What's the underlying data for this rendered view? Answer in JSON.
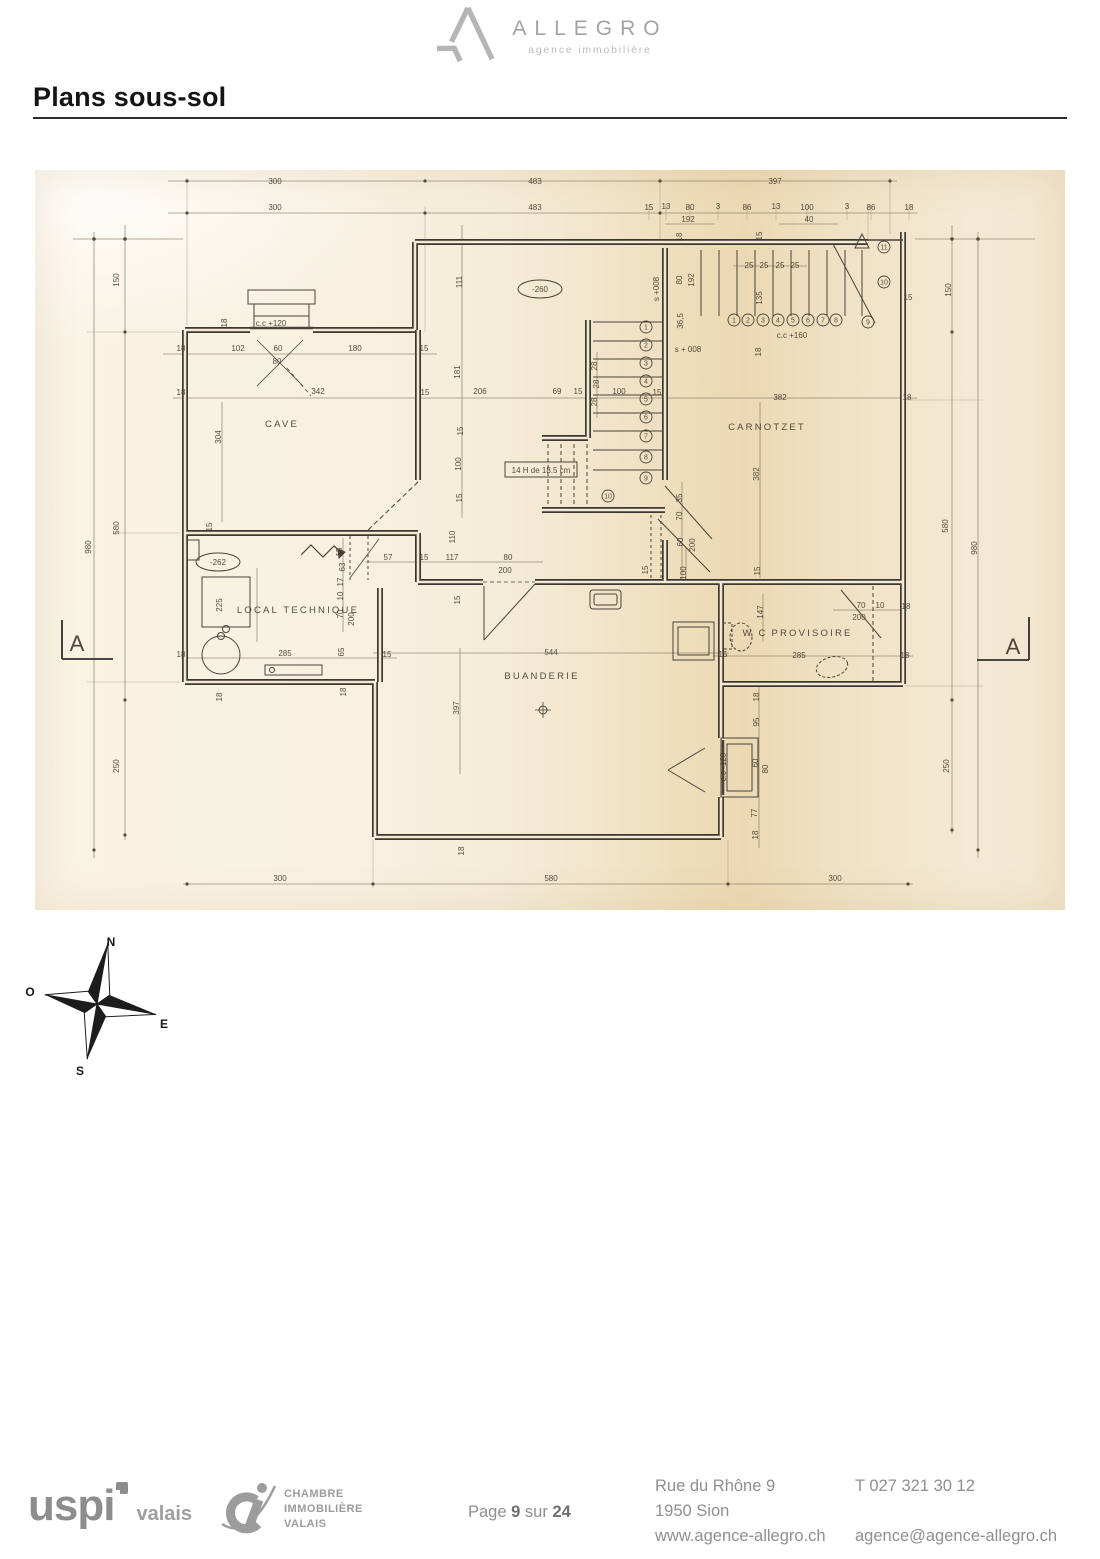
{
  "header": {
    "brand": "ALLEGRO",
    "brand_sub": "agence immobilière"
  },
  "title": "Plans sous-sol",
  "plan": {
    "rooms": [
      {
        "x": 247,
        "y": 257,
        "t": "CAVE"
      },
      {
        "x": 732,
        "y": 260,
        "t": "CARNOTZET"
      },
      {
        "x": 263,
        "y": 443,
        "t": "LOCAL TECHNIQUE"
      },
      {
        "x": 507,
        "y": 509,
        "t": "BUANDERIE"
      },
      {
        "x": 720,
        "y": 466,
        "t": "W C"
      },
      {
        "x": 777,
        "y": 466,
        "t": "PROVISOIRE"
      }
    ],
    "levels": [
      {
        "x": 505,
        "y": 119,
        "t": "-260"
      },
      {
        "x": 183,
        "y": 392,
        "t": "-262"
      }
    ],
    "note": {
      "x": 506,
      "y": 303,
      "t": "14 H de 18.5 cm"
    },
    "section_markers": [
      {
        "x": 42,
        "y": 481,
        "t": "A"
      },
      {
        "x": 978,
        "y": 484,
        "t": "A"
      }
    ],
    "steps": [
      {
        "x": 611,
        "y": 157,
        "n": "1"
      },
      {
        "x": 611,
        "y": 175,
        "n": "2"
      },
      {
        "x": 611,
        "y": 193,
        "n": "3"
      },
      {
        "x": 611,
        "y": 211,
        "n": "4"
      },
      {
        "x": 611,
        "y": 229,
        "n": "5"
      },
      {
        "x": 611,
        "y": 247,
        "n": "6"
      },
      {
        "x": 611,
        "y": 266,
        "n": "7"
      },
      {
        "x": 611,
        "y": 287,
        "n": "8"
      },
      {
        "x": 611,
        "y": 308,
        "n": "9"
      },
      {
        "x": 573,
        "y": 326,
        "n": "10"
      },
      {
        "x": 699,
        "y": 150,
        "n": "1"
      },
      {
        "x": 713,
        "y": 150,
        "n": "2"
      },
      {
        "x": 728,
        "y": 150,
        "n": "3"
      },
      {
        "x": 743,
        "y": 150,
        "n": "4"
      },
      {
        "x": 758,
        "y": 150,
        "n": "5"
      },
      {
        "x": 773,
        "y": 150,
        "n": "6"
      },
      {
        "x": 788,
        "y": 150,
        "n": "7"
      },
      {
        "x": 801,
        "y": 150,
        "n": "8"
      },
      {
        "x": 833,
        "y": 152,
        "n": "9"
      },
      {
        "x": 849,
        "y": 112,
        "n": "10"
      },
      {
        "x": 849,
        "y": 77,
        "n": "11"
      }
    ],
    "dims": [
      {
        "x": 240,
        "y": 14,
        "t": "300"
      },
      {
        "x": 500,
        "y": 14,
        "t": "483"
      },
      {
        "x": 740,
        "y": 14,
        "t": "397"
      },
      {
        "x": 240,
        "y": 40,
        "t": "300"
      },
      {
        "x": 500,
        "y": 40,
        "t": "483"
      },
      {
        "x": 614,
        "y": 40,
        "t": "15"
      },
      {
        "x": 631,
        "y": 39,
        "t": "13"
      },
      {
        "x": 655,
        "y": 40,
        "t": "80"
      },
      {
        "x": 683,
        "y": 39,
        "t": "3"
      },
      {
        "x": 712,
        "y": 40,
        "t": "86"
      },
      {
        "x": 741,
        "y": 39,
        "t": "13"
      },
      {
        "x": 772,
        "y": 40,
        "t": "100"
      },
      {
        "x": 812,
        "y": 39,
        "t": "3"
      },
      {
        "x": 836,
        "y": 40,
        "t": "86"
      },
      {
        "x": 874,
        "y": 40,
        "t": "18"
      },
      {
        "x": 653,
        "y": 52,
        "t": "192"
      },
      {
        "x": 774,
        "y": 52,
        "t": "40"
      },
      {
        "x": 84,
        "y": 110,
        "t": "150",
        "r": 1
      },
      {
        "x": 84,
        "y": 358,
        "t": "580",
        "r": 1
      },
      {
        "x": 56,
        "y": 377,
        "t": "980",
        "r": 1
      },
      {
        "x": 84,
        "y": 596,
        "t": "250",
        "r": 1
      },
      {
        "x": 916,
        "y": 120,
        "t": "150",
        "r": 1
      },
      {
        "x": 913,
        "y": 356,
        "t": "580",
        "r": 1
      },
      {
        "x": 942,
        "y": 378,
        "t": "980",
        "r": 1
      },
      {
        "x": 914,
        "y": 596,
        "t": "250",
        "r": 1
      },
      {
        "x": 146,
        "y": 181,
        "t": "18"
      },
      {
        "x": 203,
        "y": 181,
        "t": "102"
      },
      {
        "x": 243,
        "y": 181,
        "t": "60"
      },
      {
        "x": 242,
        "y": 194,
        "t": "80"
      },
      {
        "x": 320,
        "y": 181,
        "t": "180"
      },
      {
        "x": 389,
        "y": 181,
        "t": "15"
      },
      {
        "x": 146,
        "y": 225,
        "t": "18"
      },
      {
        "x": 283,
        "y": 224,
        "t": "342"
      },
      {
        "x": 390,
        "y": 225,
        "t": "15"
      },
      {
        "x": 186,
        "y": 267,
        "t": "304",
        "r": 1
      },
      {
        "x": 192,
        "y": 153,
        "t": "18",
        "r": 1
      },
      {
        "x": 236,
        "y": 156,
        "t": "c.c +120"
      },
      {
        "x": 177,
        "y": 357,
        "t": "15",
        "r": 1
      },
      {
        "x": 427,
        "y": 112,
        "t": "111",
        "r": 1
      },
      {
        "x": 425,
        "y": 202,
        "t": "181",
        "r": 1
      },
      {
        "x": 445,
        "y": 224,
        "t": "206"
      },
      {
        "x": 522,
        "y": 224,
        "t": "69"
      },
      {
        "x": 543,
        "y": 224,
        "t": "15"
      },
      {
        "x": 584,
        "y": 224,
        "t": "100"
      },
      {
        "x": 622,
        "y": 225,
        "t": "15"
      },
      {
        "x": 562,
        "y": 196,
        "t": "28",
        "r": 1
      },
      {
        "x": 564,
        "y": 214,
        "t": "28",
        "r": 1
      },
      {
        "x": 562,
        "y": 232,
        "t": "28",
        "r": 1
      },
      {
        "x": 428,
        "y": 261,
        "t": "15",
        "r": 1
      },
      {
        "x": 426,
        "y": 294,
        "t": "100",
        "r": 1
      },
      {
        "x": 427,
        "y": 328,
        "t": "15",
        "r": 1
      },
      {
        "x": 420,
        "y": 367,
        "t": "110",
        "r": 1
      },
      {
        "x": 624,
        "y": 119,
        "t": "s +008",
        "r": 1
      },
      {
        "x": 647,
        "y": 110,
        "t": "80",
        "r": 1
      },
      {
        "x": 659,
        "y": 110,
        "t": "192",
        "r": 1
      },
      {
        "x": 647,
        "y": 67,
        "t": "18",
        "r": 1
      },
      {
        "x": 727,
        "y": 66,
        "t": "15",
        "r": 1
      },
      {
        "x": 648,
        "y": 151,
        "t": "36,5",
        "r": 1
      },
      {
        "x": 653,
        "y": 182,
        "t": "s + 008"
      },
      {
        "x": 726,
        "y": 182,
        "t": "18",
        "r": 1
      },
      {
        "x": 714,
        "y": 98,
        "t": "25"
      },
      {
        "x": 729,
        "y": 98,
        "t": "25"
      },
      {
        "x": 745,
        "y": 98,
        "t": "25"
      },
      {
        "x": 760,
        "y": 98,
        "t": "25"
      },
      {
        "x": 727,
        "y": 128,
        "t": "135",
        "r": 1
      },
      {
        "x": 757,
        "y": 168,
        "t": "c.c +160"
      },
      {
        "x": 873,
        "y": 130,
        "t": "15"
      },
      {
        "x": 745,
        "y": 230,
        "t": "382"
      },
      {
        "x": 872,
        "y": 230,
        "t": "18"
      },
      {
        "x": 724,
        "y": 304,
        "t": "382",
        "r": 1
      },
      {
        "x": 725,
        "y": 401,
        "t": "15",
        "r": 1
      },
      {
        "x": 647,
        "y": 328,
        "t": "35",
        "r": 1
      },
      {
        "x": 647,
        "y": 346,
        "t": "70",
        "r": 1
      },
      {
        "x": 648,
        "y": 372,
        "t": "60",
        "r": 1
      },
      {
        "x": 660,
        "y": 375,
        "t": "200",
        "r": 1
      },
      {
        "x": 651,
        "y": 403,
        "t": "100",
        "r": 1
      },
      {
        "x": 353,
        "y": 390,
        "t": "57"
      },
      {
        "x": 389,
        "y": 390,
        "t": "15"
      },
      {
        "x": 417,
        "y": 390,
        "t": "117"
      },
      {
        "x": 473,
        "y": 390,
        "t": "80"
      },
      {
        "x": 470,
        "y": 403,
        "t": "200"
      },
      {
        "x": 307,
        "y": 382,
        "t": "15",
        "r": 1
      },
      {
        "x": 310,
        "y": 397,
        "t": "63",
        "r": 1
      },
      {
        "x": 308,
        "y": 412,
        "t": "17",
        "r": 1
      },
      {
        "x": 308,
        "y": 426,
        "t": "10",
        "r": 1
      },
      {
        "x": 308,
        "y": 444,
        "t": "70",
        "r": 1
      },
      {
        "x": 319,
        "y": 449,
        "t": "200",
        "r": 1
      },
      {
        "x": 425,
        "y": 430,
        "t": "15",
        "r": 1
      },
      {
        "x": 187,
        "y": 435,
        "t": "225",
        "r": 1
      },
      {
        "x": 146,
        "y": 487,
        "t": "18"
      },
      {
        "x": 250,
        "y": 486,
        "t": "285"
      },
      {
        "x": 309,
        "y": 482,
        "t": "65",
        "r": 1
      },
      {
        "x": 352,
        "y": 487,
        "t": "15"
      },
      {
        "x": 187,
        "y": 527,
        "t": "18",
        "r": 1
      },
      {
        "x": 311,
        "y": 522,
        "t": "18",
        "r": 1
      },
      {
        "x": 516,
        "y": 485,
        "t": "544"
      },
      {
        "x": 424,
        "y": 538,
        "t": "397",
        "r": 1
      },
      {
        "x": 429,
        "y": 681,
        "t": "18",
        "r": 1
      },
      {
        "x": 728,
        "y": 442,
        "t": "147",
        "r": 1
      },
      {
        "x": 826,
        "y": 438,
        "t": "70"
      },
      {
        "x": 845,
        "y": 438,
        "t": "10"
      },
      {
        "x": 871,
        "y": 439,
        "t": "18"
      },
      {
        "x": 824,
        "y": 450,
        "t": "200"
      },
      {
        "x": 764,
        "y": 488,
        "t": "285"
      },
      {
        "x": 870,
        "y": 488,
        "t": "18"
      },
      {
        "x": 688,
        "y": 487,
        "t": "15"
      },
      {
        "x": 613,
        "y": 400,
        "t": "15",
        "r": 1
      },
      {
        "x": 724,
        "y": 527,
        "t": "18",
        "r": 1
      },
      {
        "x": 724,
        "y": 552,
        "t": "95",
        "r": 1
      },
      {
        "x": 723,
        "y": 593,
        "t": "60",
        "r": 1
      },
      {
        "x": 733,
        "y": 599,
        "t": "80",
        "r": 1
      },
      {
        "x": 722,
        "y": 643,
        "t": "77",
        "r": 1
      },
      {
        "x": 723,
        "y": 665,
        "t": "18",
        "r": 1
      },
      {
        "x": 691,
        "y": 597,
        "t": "c.c -120",
        "r": 1
      },
      {
        "x": 245,
        "y": 711,
        "t": "300"
      },
      {
        "x": 516,
        "y": 711,
        "t": "580"
      },
      {
        "x": 800,
        "y": 711,
        "t": "300"
      }
    ]
  },
  "compass": {
    "north": "N",
    "south": "S",
    "east": "E",
    "west": "O"
  },
  "footer": {
    "uspi": {
      "name": "uspi",
      "region": "valais"
    },
    "civ_lines": [
      "CHAMBRE",
      "IMMOBILIÈRE",
      "VALAIS"
    ],
    "page": {
      "prefix": "Page",
      "number": "9",
      "middle": "sur",
      "total": "24"
    },
    "address": [
      "Rue du Rhône 9",
      "1950 Sion",
      "www.agence-allegro.ch"
    ],
    "contact": {
      "phone": "T 027 321 30 12",
      "email": "agence@agence-allegro.ch"
    }
  }
}
